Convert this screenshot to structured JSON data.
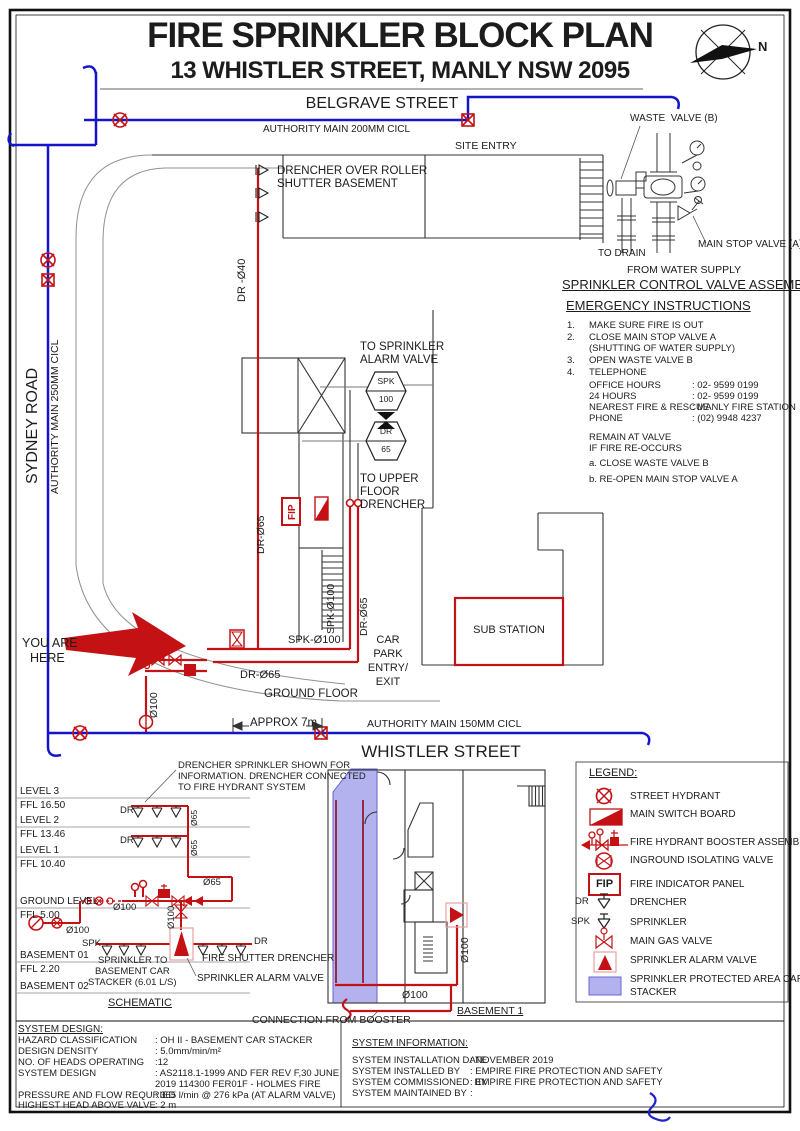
{
  "header": {
    "title": "FIRE SPRINKLER BLOCK PLAN",
    "subtitle": "13 WHISTLER STREET, MANLY NSW 2095"
  },
  "compass": {
    "n": "N"
  },
  "colors": {
    "pipe_red": "#c41214",
    "main_blue": "#1414c8",
    "protected_fill": "#b4b2ee"
  },
  "streets": {
    "belgrave": "BELGRAVE STREET",
    "authority200": "AUTHORITY MAIN 200MM CICL",
    "site_entry": "SITE ENTRY",
    "sydney": "SYDNEY ROAD",
    "authority250": "AUTHORITY MAIN 250MM CICL",
    "whistler": "WHISTLER STREET",
    "authority150": "AUTHORITY MAIN 150MM CICL",
    "approx": "APPROX 7m"
  },
  "assembly": {
    "heading": "SPRINKLER CONTROL VALVE ASSEMBLY",
    "waste": "WASTE  VALVE (B)",
    "to_drain": "TO DRAIN",
    "main_stop": "MAIN STOP VALVE (A)",
    "from_water": "FROM WATER SUPPLY"
  },
  "emergency": {
    "heading": "EMERGENCY INSTRUCTIONS",
    "n1": "1.",
    "t1": "MAKE SURE FIRE IS OUT",
    "n2": "2.",
    "t2": "CLOSE MAIN STOP VALVE A",
    "t2b": "(SHUTTING OF WATER SUPPLY)",
    "n3": "3.",
    "t3": "OPEN WASTE VALVE B",
    "n4": "4.",
    "t4": "TELEPHONE",
    "contacts": [
      {
        "label": "OFFICE HOURS",
        "value": ": 02- 9599 0199"
      },
      {
        "label": "24 HOURS",
        "value": ": 02- 9599 0199"
      },
      {
        "label": "NEAREST FIRE & RESCUE",
        "value": ": MANLY FIRE STATION"
      },
      {
        "label": "PHONE",
        "value": ": (02) 9948 4237"
      }
    ],
    "remain1": "REMAIN AT VALVE",
    "remain2": "IF FIRE RE-OCCURS",
    "step_a": "a. CLOSE WASTE VALVE B",
    "step_b": "b. RE-OPEN MAIN STOP VALVE A"
  },
  "plan": {
    "note1": "DRENCHER OVER ROLLER",
    "note2": "SHUTTER BASEMENT",
    "dr40": "DR -Ø40",
    "alarm1": "TO SPRINKLER",
    "alarm2": "ALARM VALVE",
    "spk_hex_l1": "SPK",
    "spk_hex_l2": "100",
    "dr_hex_l1": "DR",
    "dr_hex_l2": "65",
    "upper1": "TO UPPER",
    "upper2": "FLOOR",
    "upper3": "DRENCHER",
    "fip": "FIP",
    "dr65_left": "DR-Ø65",
    "spk100_vert": "SPK-Ø100",
    "dr65_vert": "DR-Ø65",
    "sub_station": "SUB STATION",
    "you1": "YOU ARE",
    "you2": "HERE",
    "spk100_h": "SPK-Ø100",
    "dr65_h": "DR-Ø65",
    "car1": "CAR",
    "car2": "PARK",
    "car3": "ENTRY/",
    "car4": "EXIT",
    "ground_floor": "GROUND FLOOR",
    "dia100": "Ø100"
  },
  "schematic": {
    "heading": "SCHEMATIC",
    "note1": "DRENCHER SPRINKLER SHOWN FOR",
    "note2": "INFORMATION. DRENCHER CONNECTED",
    "note3": "TO FIRE HYDRANT SYSTEM",
    "levels": [
      {
        "label": "LEVEL 3",
        "ffl": "FFL 16.50"
      },
      {
        "label": "LEVEL 2",
        "ffl": "FFL 13.46"
      },
      {
        "label": "LEVEL 1",
        "ffl": "FFL 10.40"
      },
      {
        "label": "GROUND LEVEL",
        "ffl": "FFL 5.00"
      },
      {
        "label": "BASEMENT 01",
        "ffl": "FFL 2.20"
      },
      {
        "label": "BASEMENT 02",
        "ffl": ""
      }
    ],
    "dr_a": "DR",
    "dr_b": "DR",
    "o65_a": "Ø65",
    "o65_b": "Ø65",
    "o65_c": "Ø65",
    "o100_a": "Ø100",
    "o100_b": "Ø100",
    "o100_c": "Ø100",
    "spk": "SPK",
    "dr_c": "DR",
    "spk_to1": "SPRINKLER TO",
    "spk_to2": "BASEMENT CAR",
    "spk_to3": "STACKER (6.01 L/S)",
    "fire_shutter": "FIRE SHUTTER DRENCHER",
    "alarm_label": "SPRINKLER ALARM VALVE"
  },
  "basement": {
    "label": "BASEMENT 1",
    "dia_h": "Ø100",
    "dia_v": "Ø100",
    "connection": "CONNECTION FROM BOOSTER"
  },
  "legend": {
    "heading": "LEGEND:",
    "fip": "FIP",
    "dr": "DR",
    "spk": "SPK",
    "items": [
      "STREET HYDRANT",
      "MAIN SWITCH BOARD",
      "FIRE HYDRANT BOOSTER ASSEMBLY",
      "INGROUND ISOLATING VALVE",
      "FIRE INDICATOR PANEL",
      "DRENCHER",
      "SPRINKLER",
      "MAIN GAS VALVE",
      "SPRINKLER ALARM VALVE",
      "SPRINKLER PROTECTED AREA CAR"
    ],
    "item9b": "STACKER"
  },
  "system_design": {
    "heading": "SYSTEM DESIGN:",
    "rows": [
      {
        "label": "HAZARD CLASSIFICATION",
        "value": ": OH II - BASEMENT CAR STACKER"
      },
      {
        "label": "DESIGN DENSITY",
        "value": ": 5.0mm/min/m²"
      },
      {
        "label": "NO. OF HEADS OPERATING",
        "value": ":12"
      },
      {
        "label": "SYSTEM DESIGN",
        "value": ": AS2118.1-1999 AND FER REV F,30 JUNE",
        "value2": "2019 114300 FER01F - HOLMES FIRE"
      },
      {
        "label": "PRESSURE AND FLOW REQURIED",
        "value": ": 365 l/min @ 276 kPa (AT ALARM VALVE)"
      },
      {
        "label": "HIGHEST HEAD ABOVE VALVE",
        "value": ": 2 m"
      }
    ]
  },
  "system_info": {
    "heading": "SYSTEM INFORMATION:",
    "rows": [
      {
        "label": "SYSTEM INSTALLATION DATE",
        "value": ": NOVEMBER 2019"
      },
      {
        "label": "SYSTEM INSTALLED BY",
        "value": ": EMPIRE FIRE PROTECTION AND SAFETY"
      },
      {
        "label": "SYSTEM COMMISSIONED  BY",
        "value": ": EMPIRE FIRE PROTECTION AND SAFETY"
      },
      {
        "label": "SYSTEM MAINTAINED BY",
        "value": ":"
      }
    ]
  }
}
